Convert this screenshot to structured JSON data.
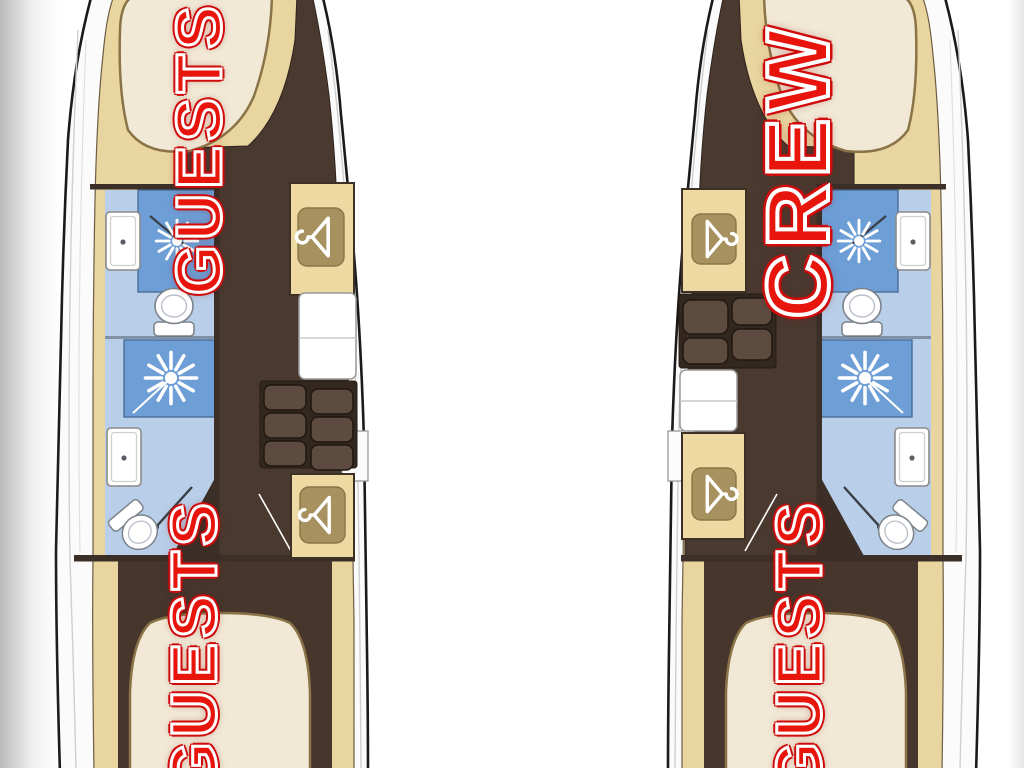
{
  "labels": {
    "port_bow": "GUESTS",
    "port_aft": "GUESTS",
    "starboard_bow": "CREW",
    "starboard_aft": "GUESTS"
  },
  "label_style": {
    "fill": "#e8150d",
    "inline_outline": "#ffffff",
    "outer_rim": "#cf0b0b"
  },
  "palette": {
    "background": "#ffffff",
    "hull_outline": "#1a1a1a",
    "deck_white": "#fbfbfb",
    "floor_tan": "#e9d5a0",
    "corridor_dark_brown": "#4a392f",
    "aft_cabin_brown": "#46362c",
    "bed_cream": "#f1e9d6",
    "bed_edge_tan": "#8a7347",
    "furniture_tan": "#eed9a2",
    "hanger_badge_tan": "#a6915f",
    "bathroom_floor_light_blue": "#b9cfe9",
    "shower_blue": "#6d9ed6",
    "fixture_white": "#ffffff",
    "step_tread_brown": "#5d4b40"
  },
  "icons": {
    "wardrobe": "hanger-icon",
    "shower": "shower-head-icon",
    "toilet": "toilet-icon",
    "sink": "sink-icon",
    "stairs": "companionway-steps"
  }
}
